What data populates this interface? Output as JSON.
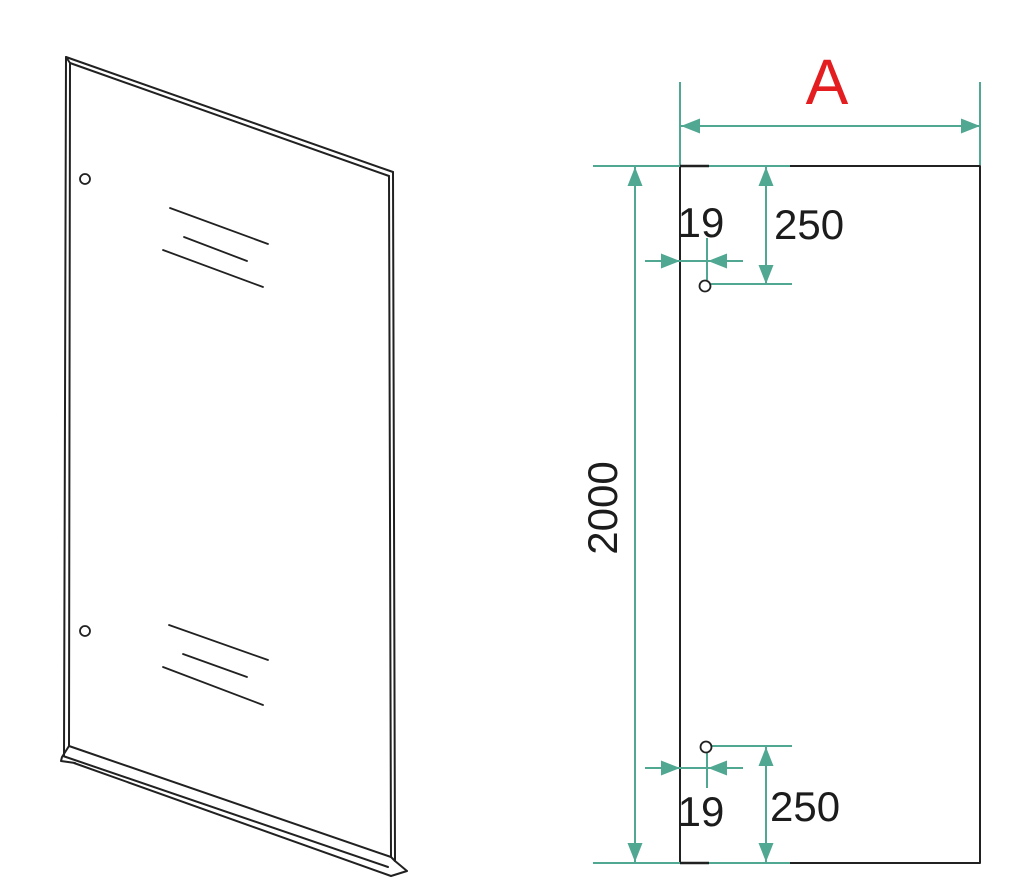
{
  "drawing": {
    "dimensions": {
      "width": {
        "label": "A"
      },
      "height": {
        "value": "2000"
      },
      "top_hole": {
        "offset_from_edge": "19",
        "offset_from_top": "250"
      },
      "bottom_hole": {
        "offset_from_edge": "19",
        "offset_from_bottom": "250"
      }
    },
    "colors": {
      "dimension_lines": "#50a892",
      "width_label": "#e41e20",
      "outline": "#212121",
      "background": "#ffffff"
    }
  }
}
